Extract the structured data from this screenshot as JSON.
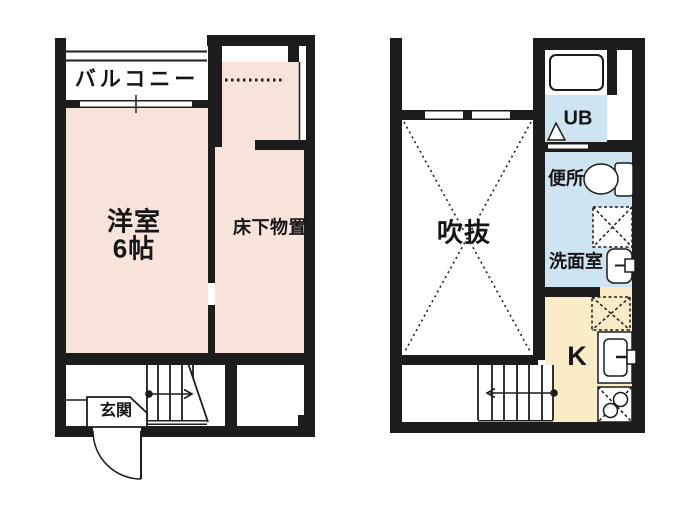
{
  "floor1": {
    "balcony_label": "バルコニー",
    "room_label": "洋室",
    "room_size_label": "6帖",
    "underfloor_storage_label": "床下物置",
    "entrance_label": "玄関"
  },
  "floor2": {
    "void_label": "吹抜",
    "unit_bath_label": "UB",
    "toilet_label": "便所",
    "washroom_label": "洗面室",
    "kitchen_label": "K"
  },
  "colors": {
    "room_pink": "#f8e3da",
    "wet_area_blue": "#cfe4f1",
    "kitchen_cream": "#f9ecc7",
    "wall_black": "#1c1c1c"
  }
}
